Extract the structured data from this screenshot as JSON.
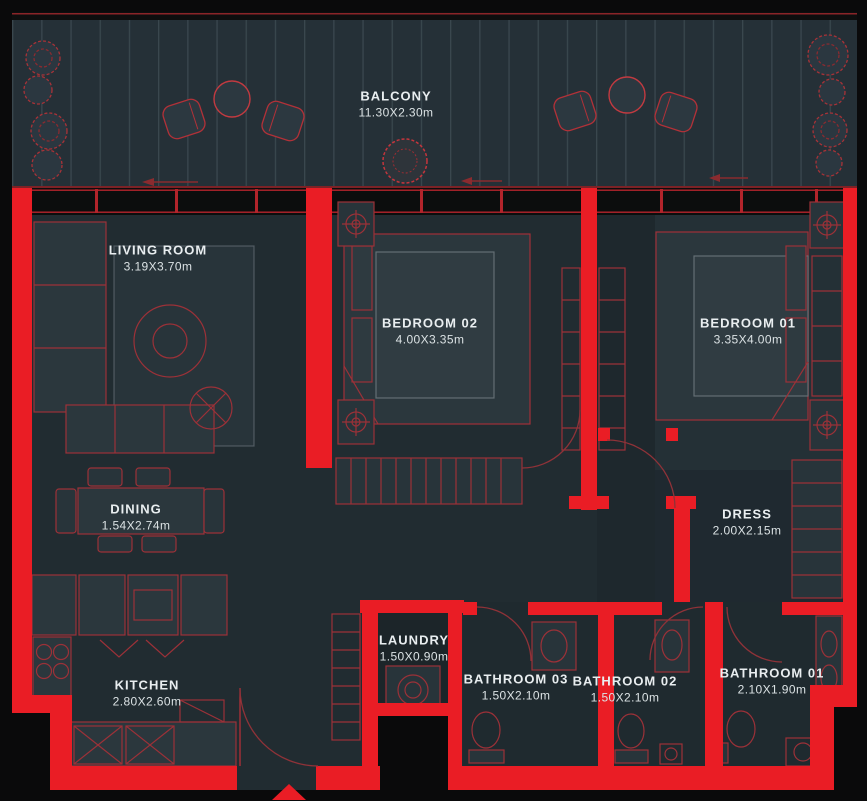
{
  "plan": {
    "type": "apartment-floor-plan",
    "colors": {
      "wall_red": "#ea1d25",
      "furniture_line_red": "#9c3138",
      "floor": "#222d33",
      "balcony_floor": "#253037",
      "label_text": "#e9eef0",
      "background": "#0a0a0b"
    },
    "entrance_marker": "triangle-up",
    "rooms": [
      {
        "id": "balcony",
        "name": "BALCONY",
        "dims": "11.30X2.30m"
      },
      {
        "id": "living-room",
        "name": "LIVING ROOM",
        "dims": "3.19X3.70m"
      },
      {
        "id": "bedroom-02",
        "name": "BEDROOM 02",
        "dims": "4.00X3.35m"
      },
      {
        "id": "bedroom-01",
        "name": "BEDROOM 01",
        "dims": "3.35X4.00m"
      },
      {
        "id": "dining",
        "name": "DINING",
        "dims": "1.54X2.74m"
      },
      {
        "id": "dress",
        "name": "DRESS",
        "dims": "2.00X2.15m"
      },
      {
        "id": "kitchen",
        "name": "KITCHEN",
        "dims": "2.80X2.60m"
      },
      {
        "id": "laundry",
        "name": "LAUNDRY",
        "dims": "1.50X0.90m"
      },
      {
        "id": "bathroom-03",
        "name": "BATHROOM 03",
        "dims": "1.50X2.10m"
      },
      {
        "id": "bathroom-02",
        "name": "BATHROOM 02",
        "dims": "1.50X2.10m"
      },
      {
        "id": "bathroom-01",
        "name": "BATHROOM 01",
        "dims": "2.10X1.90m"
      }
    ]
  }
}
